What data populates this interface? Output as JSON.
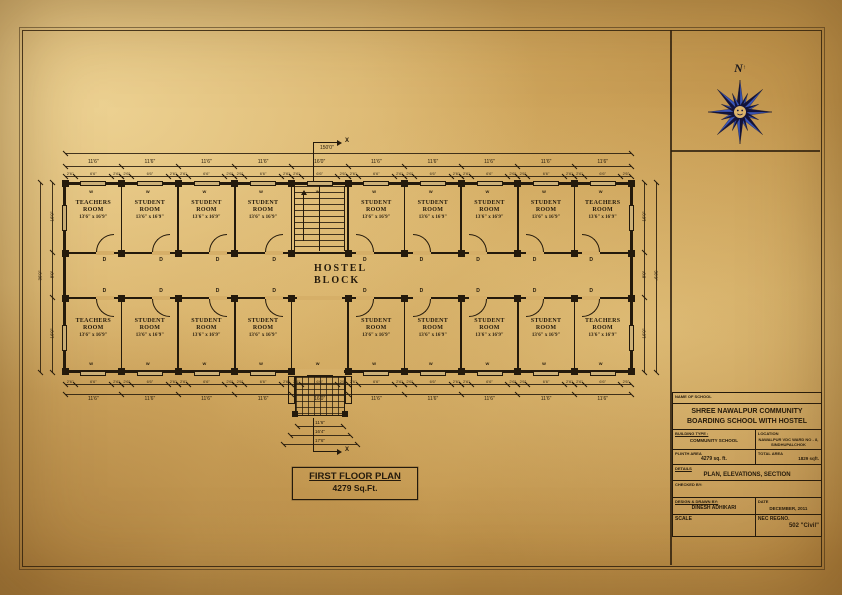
{
  "compass": {
    "north_label": "N"
  },
  "plan": {
    "block_label_line1": "HOSTEL",
    "block_label_line2": "BLOCK",
    "title": "FIRST FLOOR PLAN",
    "area": "4279 Sq.Ft.",
    "door_label": "D",
    "window_label": "W",
    "section_marker": "X",
    "rooms_top": [
      {
        "type": "room",
        "name": "TEACHERS ROOM",
        "size": "13'6\" x 16'9\""
      },
      {
        "type": "room",
        "name": "STUDENT ROOM",
        "size": "13'6\" x 16'9\""
      },
      {
        "type": "room",
        "name": "STUDENT ROOM",
        "size": "13'6\" x 16'9\""
      },
      {
        "type": "room",
        "name": "STUDENT ROOM",
        "size": "13'6\" x 16'9\""
      },
      {
        "type": "stair"
      },
      {
        "type": "room",
        "name": "STUDENT ROOM",
        "size": "13'6\" x 16'9\""
      },
      {
        "type": "room",
        "name": "STUDENT ROOM",
        "size": "13'6\" x 16'9\""
      },
      {
        "type": "room",
        "name": "STUDENT ROOM",
        "size": "13'6\" x 16'9\""
      },
      {
        "type": "room",
        "name": "STUDENT ROOM",
        "size": "13'6\" x 16'9\""
      },
      {
        "type": "room",
        "name": "TEACHERS ROOM",
        "size": "13'6\" x 16'9\""
      }
    ],
    "rooms_bottom": [
      {
        "type": "room",
        "name": "TEACHERS ROOM",
        "size": "13'6\" x 16'9\""
      },
      {
        "type": "room",
        "name": "STUDENT ROOM",
        "size": "13'6\" x 16'9\""
      },
      {
        "type": "room",
        "name": "STUDENT ROOM",
        "size": "13'6\" x 16'9\""
      },
      {
        "type": "room",
        "name": "STUDENT ROOM",
        "size": "13'6\" x 16'9\""
      },
      {
        "type": "open"
      },
      {
        "type": "room",
        "name": "STUDENT ROOM",
        "size": "13'6\" x 16'9\""
      },
      {
        "type": "room",
        "name": "STUDENT ROOM",
        "size": "13'6\" x 16'9\""
      },
      {
        "type": "room",
        "name": "STUDENT ROOM",
        "size": "13'6\" x 16'9\""
      },
      {
        "type": "room",
        "name": "STUDENT ROOM",
        "size": "13'6\" x 16'9\""
      },
      {
        "type": "room",
        "name": "TEACHERS ROOM",
        "size": "13'6\" x 16'9\""
      }
    ],
    "dims": {
      "overall_top": "150'0\"",
      "bays_top": [
        "11'6\"",
        "11'6\"",
        "11'6\"",
        "11'6\"",
        "16'0\"",
        "11'6\"",
        "11'6\"",
        "11'6\"",
        "11'6\"",
        "11'6\""
      ],
      "bays_bottom": [
        "11'6\"",
        "11'6\"",
        "11'6\"",
        "11'6\"",
        "16'0\"",
        "11'6\"",
        "11'6\"",
        "11'6\"",
        "11'6\"",
        "11'6\""
      ],
      "small_pattern": [
        "2'6\"",
        "6'6\"",
        "2'6\""
      ],
      "left_overall": "36'9\"",
      "left_segments": [
        "16'9\"",
        "8'0\"",
        "16'9\""
      ],
      "right_segments": [
        "16'9\"",
        "8'0\"",
        "16'9\""
      ],
      "entrance": [
        "11'6\"",
        "16'4\"",
        "17'6\""
      ]
    }
  },
  "title_block": {
    "header_label": "NAME OF SCHOOL",
    "school_name": "SHREE NAWALPUR COMMUNITY BOARDING SCHOOL WITH HOSTEL",
    "building_type_label": "BUILDING TYPE :",
    "building_type": "COMMUNITY SCHOOL",
    "location_label": "LOCATION",
    "location": "NAWALPUR VDC WARD NO - 8, SINDHUPALCHOK",
    "plinth_label": "PLINTH AREA",
    "plinth": "4279 sq. ft.",
    "total_label": "TOTAL AREA",
    "total": "1829 sqft.",
    "details_label": "DETAILS",
    "details": "PLAN, ELEVATIONS, SECTION",
    "checked_label": "CHECKED BY:",
    "designed_label": "DESIGN & DRAWN BY:",
    "designed": "DINESH ADHIKARI",
    "date_label": "DATE",
    "date": "DECEMBER, 2011",
    "scale_label": "SCALE",
    "regno_label": "NEC REGNO.",
    "regno": "502 \"Civil\""
  }
}
